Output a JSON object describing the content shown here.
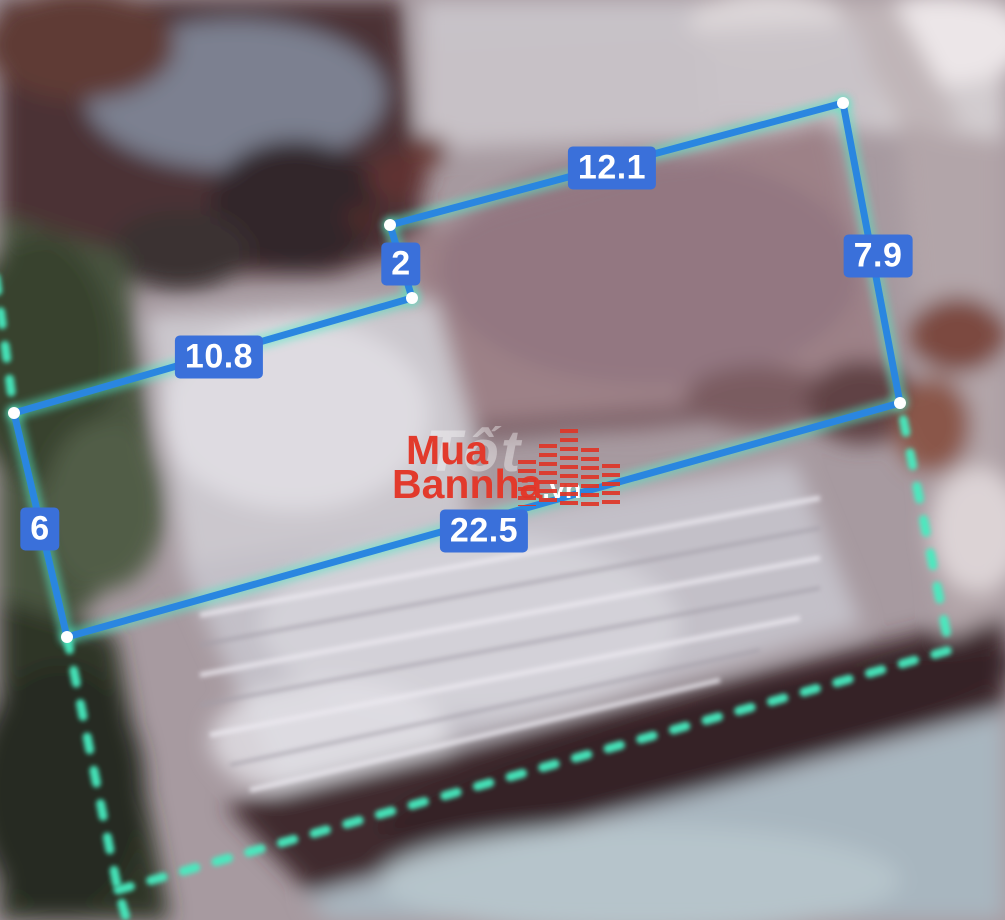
{
  "overlay": {
    "colors": {
      "line": "#2a86e0",
      "glow": "#52e9c5",
      "boundary": "#46ecc0",
      "label_bg": "#3a70da",
      "label_text": "#ffffff",
      "vertex": "#ffffff"
    },
    "segments": [
      {
        "label": "12.1",
        "from": [
          843,
          103
        ],
        "to": [
          390,
          225
        ],
        "label_at": [
          612,
          168
        ]
      },
      {
        "label": "2",
        "from": [
          390,
          225
        ],
        "to": [
          412,
          298
        ],
        "label_at": [
          401,
          264
        ]
      },
      {
        "label": "10.8",
        "from": [
          412,
          298
        ],
        "to": [
          14,
          413
        ],
        "label_at": [
          219,
          357
        ]
      },
      {
        "label": "6",
        "from": [
          14,
          413
        ],
        "to": [
          67,
          637
        ],
        "label_at": [
          40,
          529
        ]
      },
      {
        "label": "22.5",
        "from": [
          67,
          637
        ],
        "to": [
          900,
          403
        ],
        "label_at": [
          484,
          531
        ]
      },
      {
        "label": "7.9",
        "from": [
          843,
          103
        ],
        "to": [
          900,
          403
        ],
        "label_at": [
          878,
          256
        ]
      }
    ],
    "vertices": [
      [
        843,
        103
      ],
      [
        390,
        225
      ],
      [
        412,
        298
      ],
      [
        14,
        413
      ],
      [
        67,
        637
      ],
      [
        900,
        403
      ]
    ],
    "boundary": {
      "paths": [
        [
          [
            -4,
            278
          ],
          [
            14,
            413
          ]
        ],
        [
          [
            67,
            637
          ],
          [
            118,
            890
          ],
          [
            127,
            921
          ]
        ],
        [
          [
            118,
            890
          ],
          [
            950,
            650
          ],
          [
            900,
            403
          ]
        ]
      ]
    }
  },
  "watermark": {
    "line1": "Mua",
    "line2": "Bannha",
    "suffix": ".vn",
    "ghost_text": "Tốt",
    "brand_color": "#e23a2c",
    "suffix_color": "#ffffff"
  }
}
